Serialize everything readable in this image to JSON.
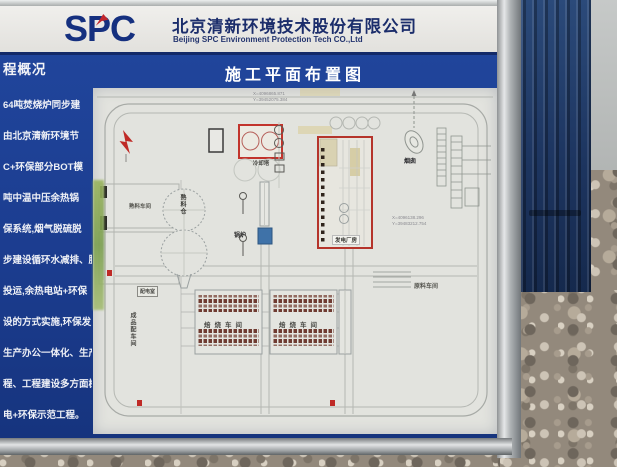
{
  "header": {
    "logo_text": "SPC",
    "company_cn": "北京清新环境技术股份有限公司",
    "company_en": "Beijing SPC Environment Protection Tech CO.,Ltd"
  },
  "left_panel": {
    "title": "程概况",
    "lines": [
      "64吨焚烧炉同步建",
      "由北京清新环境节",
      "C+环保部分BOT模",
      "吨中温中压余热锅",
      "保系统,烟气脱硫脱",
      "步建设循环水减排、脱",
      "投运,余热电站+环保",
      "设的方式实施,环保发",
      "生产办公一体化、生产",
      "程、工程建设多方面树立",
      "电+环保示范工程。"
    ]
  },
  "diagram": {
    "title": "施工平面布置图",
    "coords": {
      "top_line1": "X=4096865.871",
      "top_line2": "Y=39452075.384",
      "right_line1": "X=4096138.296",
      "right_line2": "Y=39483212.754"
    },
    "labels": {
      "cooling_tower": "冷却塔",
      "clinker_silo": "熟料仓",
      "clinker_workshop": "熟料车间",
      "boiler": "锅炉",
      "power_house": "发电厂房",
      "chimney": "烟囱",
      "raw_material_workshop": "原料车间",
      "calcining_workshop_left": "焙烧车间",
      "calcining_workshop_right": "焙烧车间",
      "power_distribution_room": "配电室",
      "product_distribution": "成品配车间"
    }
  },
  "colors": {
    "panel_blue": "#1d3f92",
    "logo_blue": "#15307f",
    "logo_red": "#c1272d",
    "highlight_red": "#b5342b",
    "container_blue": "#1d3560",
    "paper": "#e2e3de"
  }
}
